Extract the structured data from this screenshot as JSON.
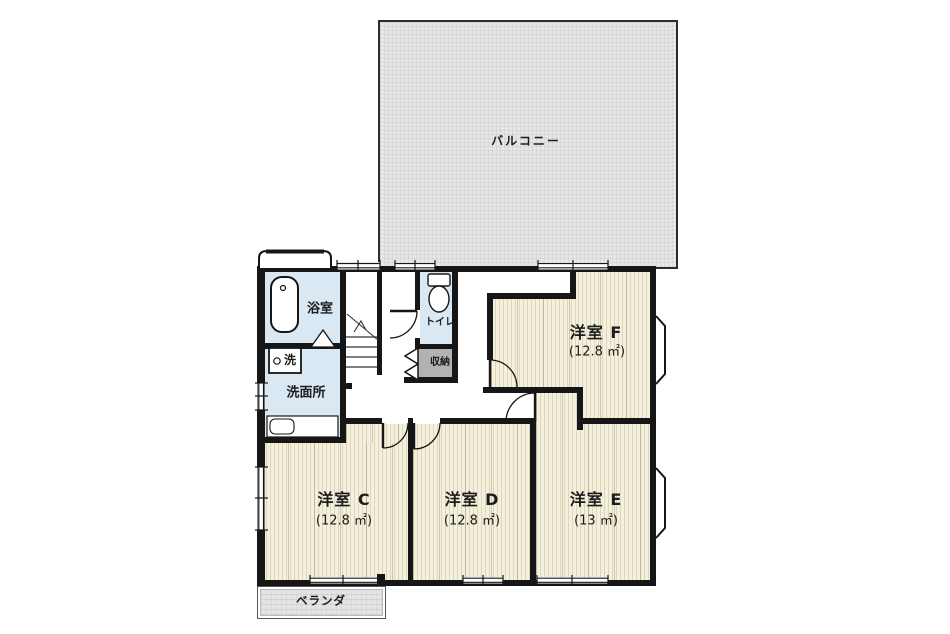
{
  "plan": {
    "balcony": {
      "label": "バルコニー"
    },
    "veranda": {
      "label": "ベランダ"
    },
    "bathroom": {
      "label": "浴室"
    },
    "washroom": {
      "label": "洗面所"
    },
    "washer": {
      "label": "洗"
    },
    "toilet": {
      "label": "トイレ"
    },
    "storage": {
      "label": "収納"
    },
    "rooms": {
      "c": {
        "name": "洋室 C",
        "area": "(12.8 ㎡)"
      },
      "d": {
        "name": "洋室 D",
        "area": "(12.8 ㎡)"
      },
      "e": {
        "name": "洋室 E",
        "area": "(13 ㎡)"
      },
      "f": {
        "name": "洋室 F",
        "area": "(12.8 ㎡)"
      }
    }
  },
  "colors": {
    "wall": "#161616",
    "floor": "#f4f0dc",
    "wet_area": "#d9e8f3",
    "storage": "#b2b2b2",
    "balcony": "#e7e7e9",
    "veranda": "#e4e4e6",
    "text": "#1c1c1c"
  }
}
